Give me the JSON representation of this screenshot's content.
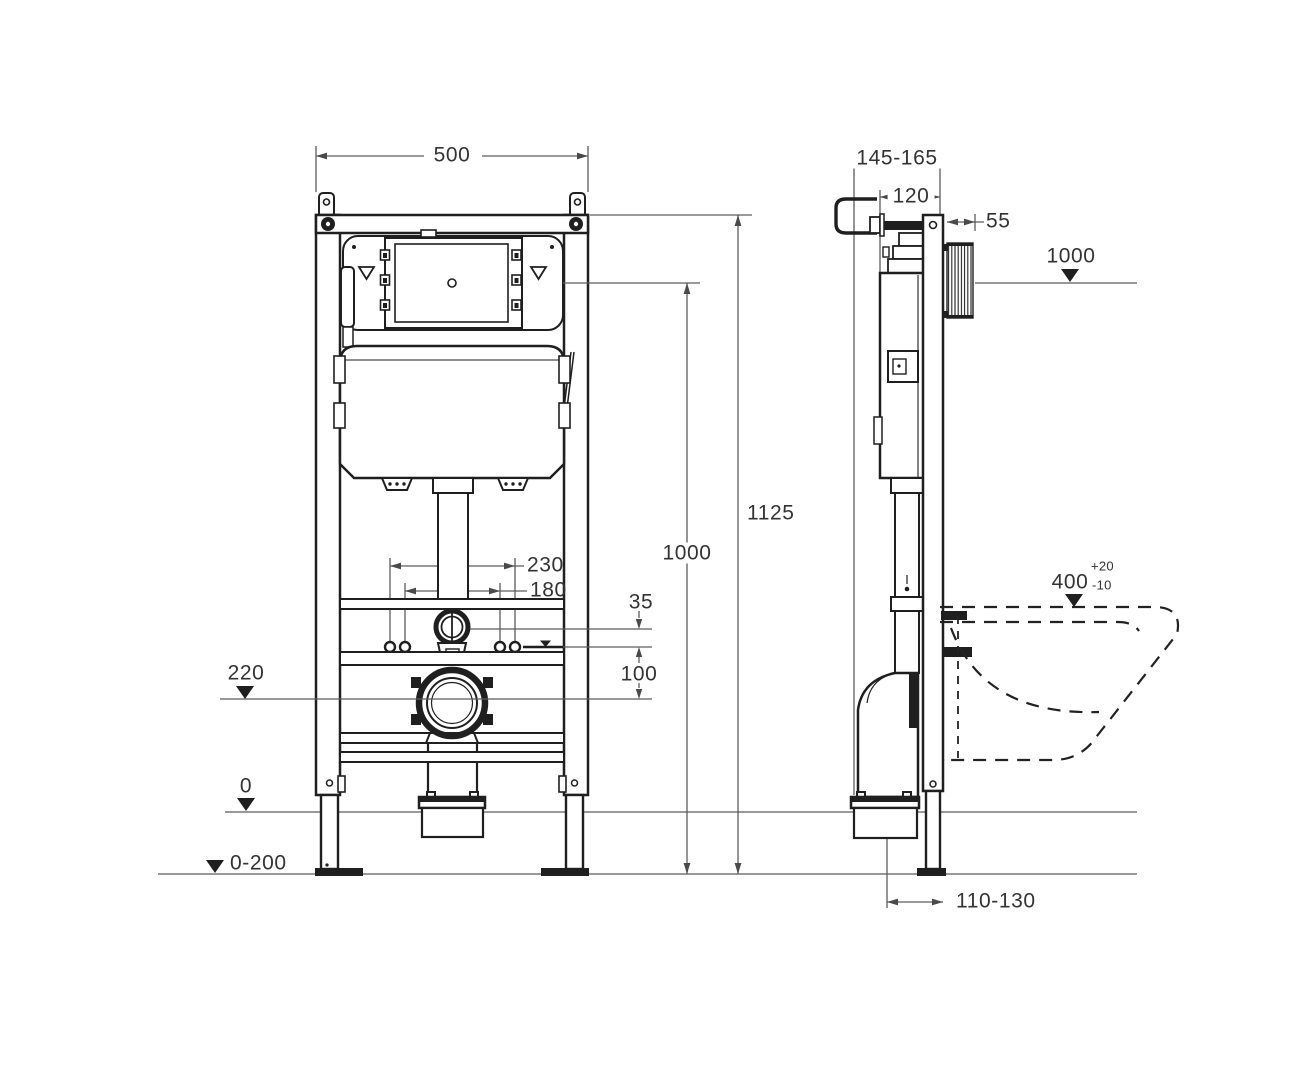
{
  "colors": {
    "line": "#1f1f1f",
    "dim": "#5c5c5c",
    "text": "#333333",
    "background": "#ffffff"
  },
  "front_view": {
    "width": "500",
    "overall_height": "1125",
    "actuation_height": "1000",
    "fixing_outer": "230",
    "fixing_inner": "180",
    "flush_gap": "35",
    "drain_gap": "100",
    "drain_level": "220",
    "zero_level": "0",
    "floor_range": "0-200"
  },
  "side_view": {
    "depth_range": "145-165",
    "cistern_depth": "120",
    "cover_depth": "55",
    "ref_level": "1000",
    "bowl_level": "400",
    "bowl_tol_plus": "+20",
    "bowl_tol_minus": "-10",
    "outlet_offset": "110-130"
  }
}
